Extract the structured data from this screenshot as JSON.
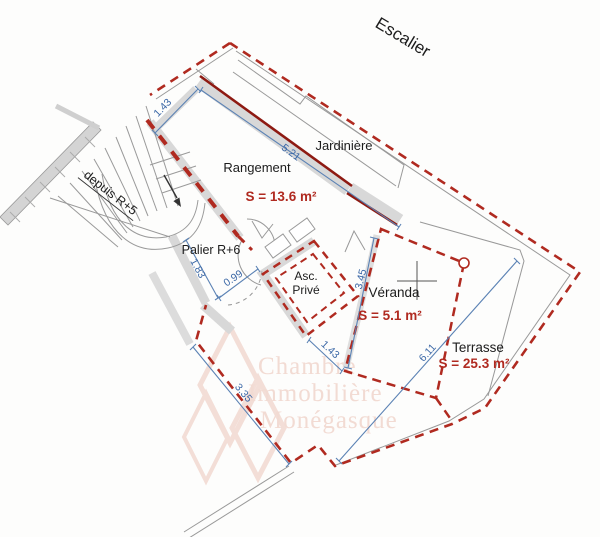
{
  "plan": {
    "escalier_label": "Escalier",
    "jardiniere_label": "Jardinière",
    "rangement_label": "Rangement",
    "rangement_area": "S = 13.6 m²",
    "depuis_label": "depuis R+5",
    "palier_label": "Palier R+6",
    "asc_label_line1": "Asc.",
    "asc_label_line2": "Privé",
    "veranda_label": "Véranda",
    "veranda_area": "S = 5.1 m²",
    "terrasse_label": "Terrasse",
    "terrasse_area": "S = 25.3 m²"
  },
  "dimensions": {
    "wall_top_left": "1.43",
    "wall_jardiniere": "5.21",
    "palier_left": "1.83",
    "palier_opening": "0.99",
    "veranda_left": "3.45",
    "walkway": "1.43",
    "terrasse_diagonal": "6.11",
    "terrasse_west": "3.35"
  },
  "watermark": {
    "line1": "Chambre",
    "line2": "Immobilière",
    "line3": "Monégasque"
  },
  "colors": {
    "boundary_dashed": "#b02a20",
    "load_bearing_wall": "#8e1a12",
    "dimension_blue": "#4a74aa",
    "area_text_red": "#b02a20",
    "wall_fill_gray": "#d8d8d8",
    "watermark_pink": "#f3ded7"
  }
}
